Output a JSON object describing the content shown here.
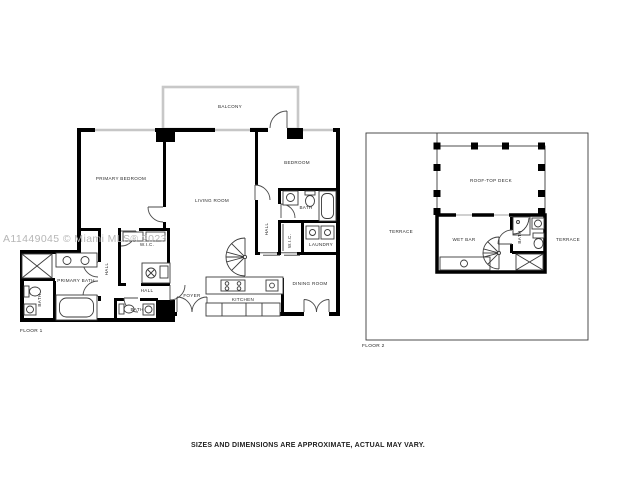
{
  "watermark": "A11449045 © Miami MLS® 2023",
  "disclaimer": "SIZES AND DIMENSIONS ARE APPROXIMATE, ACTUAL MAY VARY.",
  "colors": {
    "wall": "#000000",
    "window": "#c6c6c6",
    "balcony_wall": "#c8c8c8",
    "watermark": "#b6b6b6",
    "label": "#2b2b2b",
    "background": "#ffffff"
  },
  "floor1": {
    "label": "FLOOR 1",
    "rooms": {
      "balcony": "BALCONY",
      "primary_bedroom": "PRIMARY BEDROOM",
      "living_room": "LIVING ROOM",
      "bedroom": "BEDROOM",
      "bedroom_bath": "BATH",
      "hall_right": "HALL",
      "wic_right": "W.I.C.",
      "laundry": "LAUNDRY",
      "dining_room": "DINING ROOM",
      "kitchen": "KITCHEN",
      "foyer": "FOYER",
      "wic_center": "W.I.C.",
      "hall_left": "HALL",
      "hall_center": "HALL",
      "bath_center": "BATH",
      "primary_bath": "PRIMARY BATH",
      "bath_left": "BATH"
    }
  },
  "floor2": {
    "label": "FLOOR 2",
    "rooms": {
      "roof_top_deck": "ROOF-TOP DECK",
      "terrace_left": "TERRACE",
      "wet_bar": "WET BAR",
      "bath": "BATH",
      "terrace_right": "TERRACE"
    }
  }
}
